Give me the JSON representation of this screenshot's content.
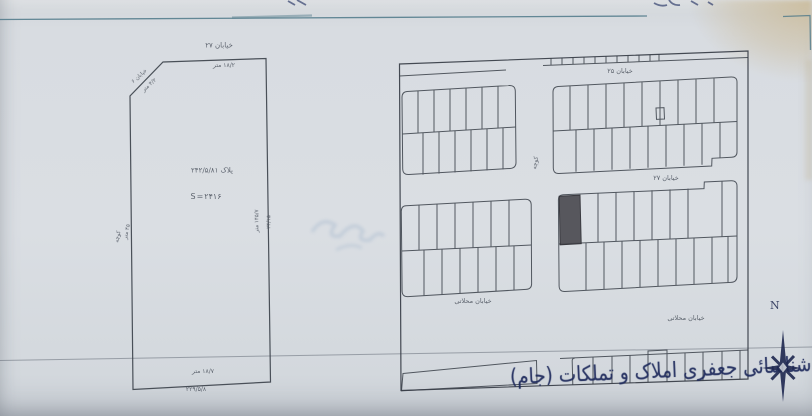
{
  "left_parcel": {
    "street_top": "خیابان ۲۷",
    "top_length": "۱۸/۲ متر",
    "corner_street": "خیابان ۶",
    "corner_length": "۴/۲ متر",
    "plot_label": "پلاک ۲۴۲/۵/۸۱",
    "area_label": "S=۲۴۱۶",
    "east_length_inner": "۱۴۵/۷ متر",
    "east_length_outer": "۲۴/۱۵",
    "west_label_outer": "کوچه",
    "west_length_inner": "۴۵ متر",
    "bottom_length_inner": "۱۸/۷ متر",
    "bottom_length_outer": "۲۲۹/۵/۸"
  },
  "block_plan": {
    "street_25": "خیابان ۲۵",
    "street_27": "خیابان ۲۷",
    "alley": "کوچه",
    "street_mahallati_a": "خیابان محلاتی",
    "street_mahallati_b": "خیابان محلاتی"
  },
  "annotations": {
    "handwriting": "شناسائی جعفری املاک و تملکات (جام)",
    "compass_north": "N"
  },
  "colors": {
    "paper": "#d8dce1",
    "plan_line": "#3a4049",
    "frame_line": "#4e7888",
    "ink_navy": "#1e2a5c",
    "highlighted_lot": "#4c4c52"
  }
}
